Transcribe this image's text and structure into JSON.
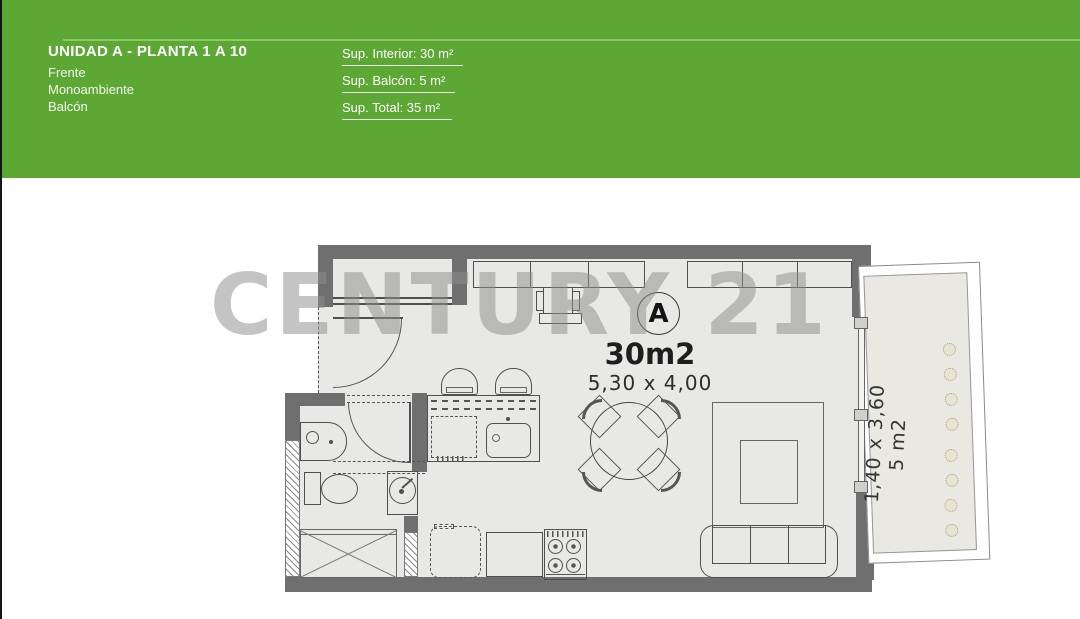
{
  "header": {
    "title": "UNIDAD A - PLANTA 1 A 10",
    "features": [
      "Frente",
      "Monoambiente",
      "Balcón"
    ],
    "areas": [
      {
        "label": "Sup. Interior: 30 m²"
      },
      {
        "label": "Sup. Balcón: 5 m²"
      },
      {
        "label": "Sup. Total: 35 m²"
      }
    ],
    "background_color": "#5da835",
    "divider_color": "#8dc766"
  },
  "watermark": {
    "text": "CENTURY 21",
    "color": "#8f8f8f"
  },
  "plan": {
    "unit_badge": "A",
    "interior_area_label": "30m2",
    "interior_dimensions_label": "5,30 x 4,00",
    "balcony": {
      "dimensions_label": "1,40 x 3,60",
      "area_label": "5 m2"
    },
    "colors": {
      "wall": "#6f6f6f",
      "floor": "#e8e8e6",
      "line": "#4f4f4f",
      "balcony_floor": "#e9e8e3",
      "plant": "#a89e7c"
    }
  }
}
